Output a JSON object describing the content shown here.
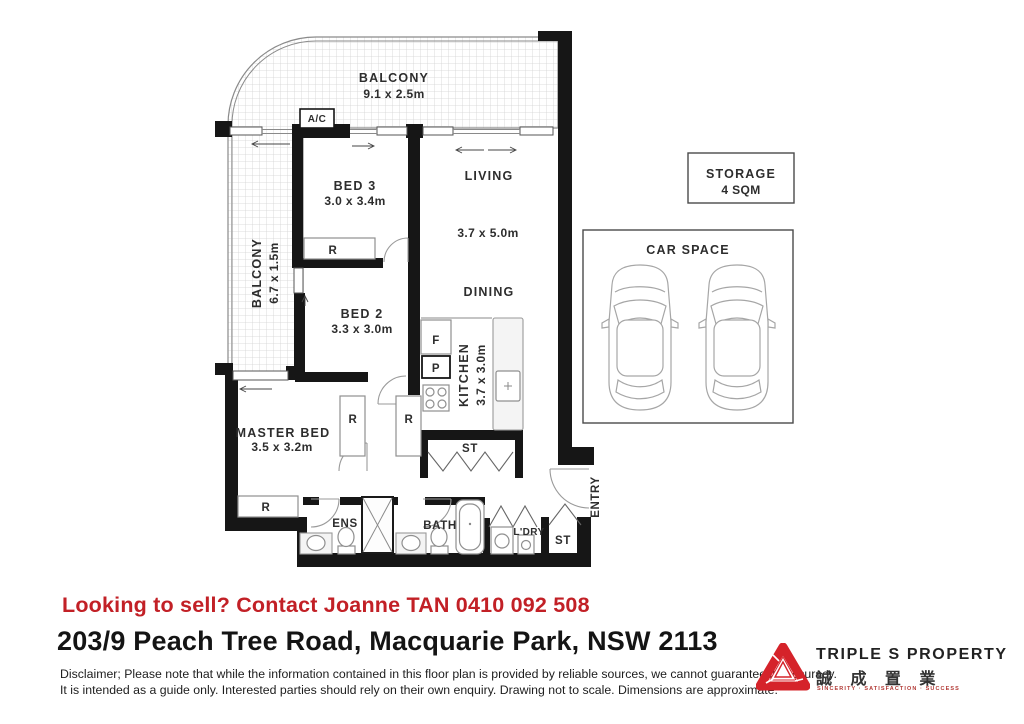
{
  "plan": {
    "balcony_top": {
      "label": "BALCONY",
      "dims": "9.1 x 2.5m"
    },
    "balcony_left": {
      "label": "BALCONY",
      "dims": "6.7 x 1.5m"
    },
    "ac": "A/C",
    "bed3": {
      "label": "BED 3",
      "dims": "3.0 x 3.4m"
    },
    "living": {
      "label": "LIVING",
      "dims": "3.7 x 5.0m"
    },
    "bed2": {
      "label": "BED 2",
      "dims": "3.3 x 3.0m"
    },
    "dining": {
      "label": "DINING"
    },
    "kitchen": {
      "label": "KITCHEN",
      "dims": "3.7 x 3.0m"
    },
    "master": {
      "label": "MASTER BED",
      "dims": "3.5 x 3.2m"
    },
    "ens": "ENS",
    "bath": "BATH",
    "ldry": "L'DRY",
    "entry": "ENTRY",
    "robe": "R",
    "store": "ST",
    "fridge": "F",
    "pantry": "P",
    "storage_box": {
      "label": "STORAGE",
      "size": "4 SQM"
    },
    "car_space": {
      "label": "CAR SPACE"
    }
  },
  "footer": {
    "contact": "Looking to sell? Contact Joanne TAN 0410 092 508",
    "address": "203/9 Peach Tree Road, Macquarie Park, NSW 2113",
    "disclaimer1": "Disclaimer; Please note that while the information contained in this floor plan is provided by reliable sources, we cannot guarantee its accuracy.",
    "disclaimer2": "It is intended as a guide only. Interested parties should rely on their own enquiry. Drawing not to scale.  Dimensions are approximate.",
    "brand": {
      "name": "TRIPLE S PROPERTY",
      "chinese": "誠 成 置 業",
      "tagline": "SINCERITY · SATISFACTION · SUCCESS"
    }
  },
  "colors": {
    "accent_red": "#c22026",
    "wall": "#161616"
  }
}
